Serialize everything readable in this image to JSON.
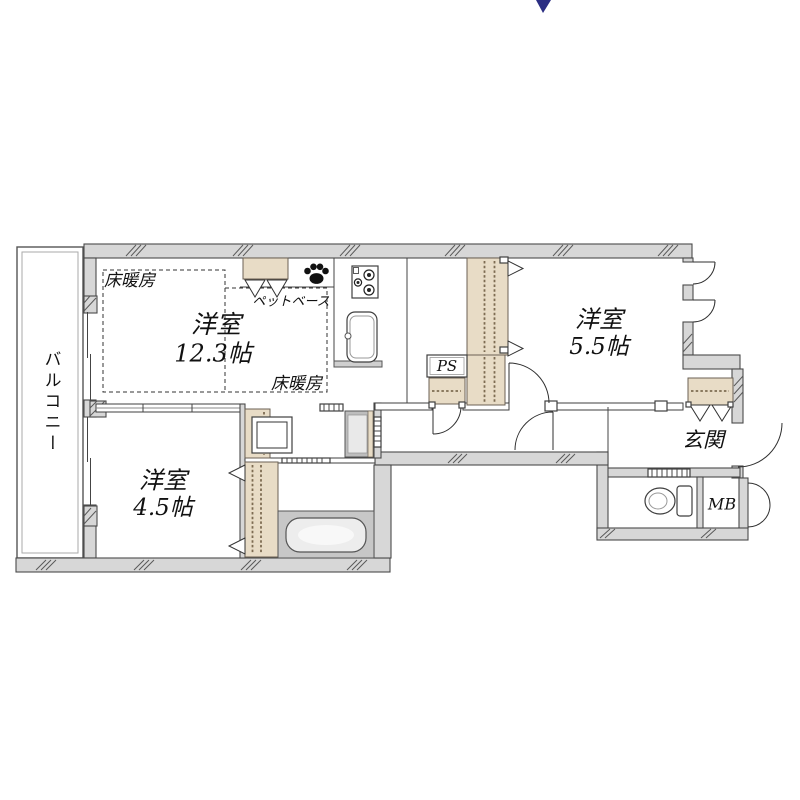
{
  "map_marker": {
    "color": "#2b2e83"
  },
  "plan": {
    "balcony_label": "バルコニー",
    "rooms": {
      "ldk": {
        "name": "洋室",
        "size": "12.3帖"
      },
      "bed2": {
        "name": "洋室",
        "size": "5.5帖"
      },
      "bed3": {
        "name": "洋室",
        "size": "4.5帖"
      }
    },
    "labels": {
      "floor_heating_a": "床暖房",
      "floor_heating_b": "床暖房",
      "pet_base": "ペットベース",
      "ps": "PS",
      "entrance": "玄関",
      "mb": "MB"
    },
    "icons": {
      "paw": "paw-print-icon"
    },
    "colors": {
      "wall": "#d7d7d7",
      "closet": "#e8dcc6",
      "bath_floor": "#c7c7c7",
      "marker": "#2b2e83"
    }
  }
}
